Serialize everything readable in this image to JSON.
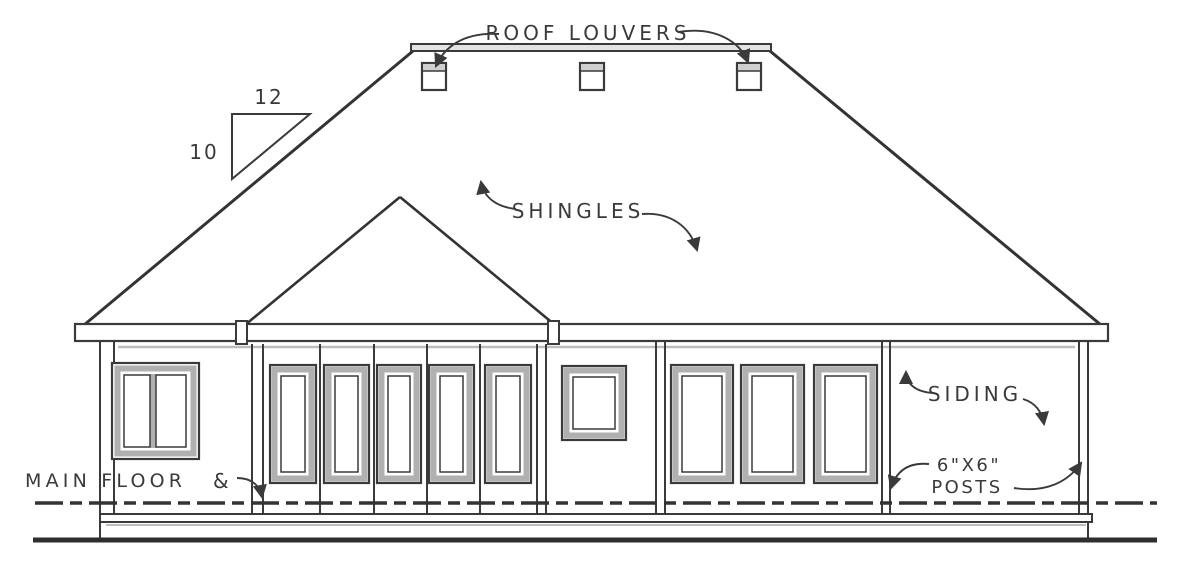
{
  "labels": {
    "roof_louvers": "ROOF LOUVERS",
    "shingles": "SHINGLES",
    "siding": "SIDING",
    "posts_size": "6\"X6\"",
    "posts_word": "POSTS",
    "main_floor": "MAIN FLOOR",
    "main_floor_symbol": "&"
  },
  "roof_pitch": {
    "run": "12",
    "rise": "10"
  },
  "colors": {
    "line": "#3a3a3a",
    "frame_shade": "#b0b0b0",
    "background": "#ffffff"
  }
}
